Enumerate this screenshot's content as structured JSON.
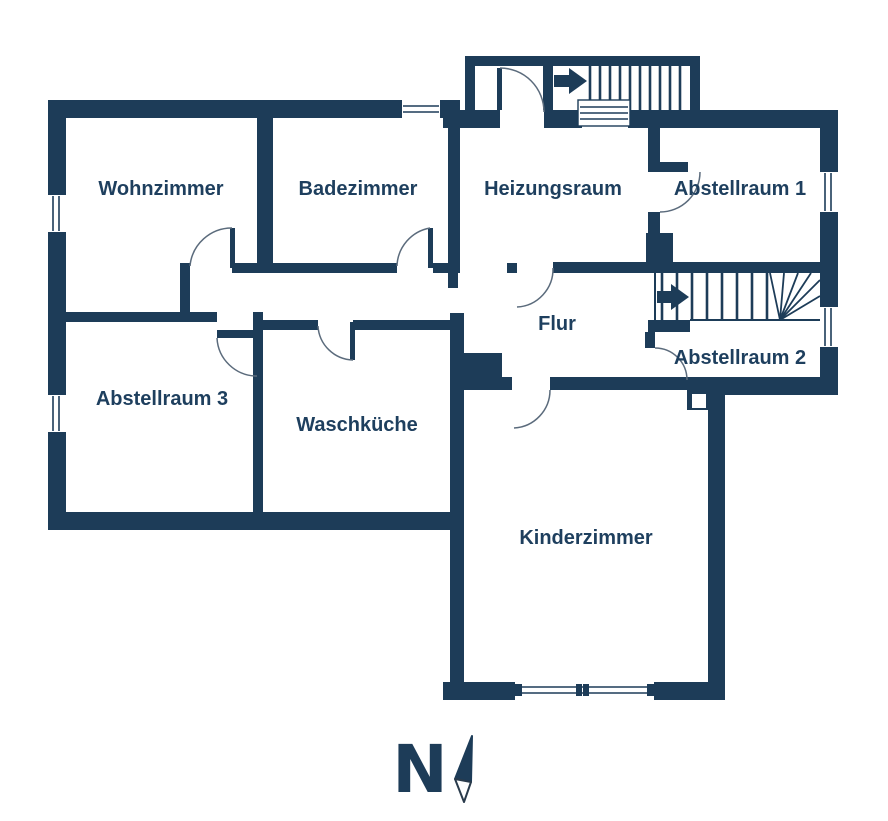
{
  "title": "Grundriss Untergeschoss (floor plan)",
  "colors": {
    "wall": "#1d3c58",
    "label_text": "#1e3f5e",
    "door_arc": "#5b6b7c",
    "background": "#ffffff"
  },
  "rooms": {
    "wohnzimmer": {
      "label": "Wohnzimmer"
    },
    "badezimmer": {
      "label": "Badezimmer"
    },
    "heizungsraum": {
      "label": "Heizungsraum"
    },
    "abstellraum1": {
      "label": "Abstellraum 1"
    },
    "flur": {
      "label": "Flur"
    },
    "abstellraum2": {
      "label": "Abstellraum 2"
    },
    "abstellraum3": {
      "label": "Abstellraum 3"
    },
    "waschkueche": {
      "label": "Waschküche"
    },
    "kinderzimmer": {
      "label": "Kinderzimmer"
    }
  },
  "stairs": {
    "upper_staircase_direction": "right",
    "lower_staircase_direction": "right"
  },
  "compass": {
    "north_label": "N",
    "needle_direction": "up-right"
  }
}
